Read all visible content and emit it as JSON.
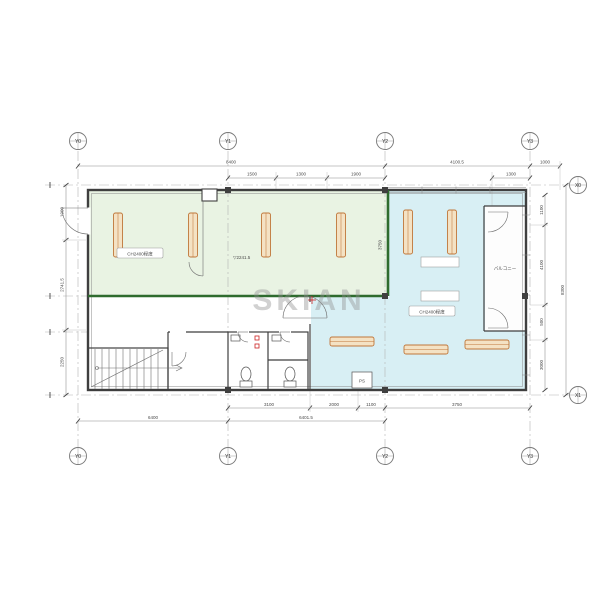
{
  "watermark": "SKIAN",
  "grid": {
    "cols": [
      "Y0",
      "Y1",
      "Y2",
      "Y3"
    ],
    "rows": [
      "X0",
      "X1"
    ]
  },
  "dims": {
    "top1": [
      "8400",
      "4100.5",
      "1000"
    ],
    "top2": [
      "1500",
      "1300",
      "1900",
      "1300"
    ],
    "bottom1": [
      "3100",
      "2000",
      "1100",
      "3750"
    ],
    "bottom2": [
      "6400",
      "6401.5"
    ],
    "left": [
      "1900",
      "2741.5",
      "2250"
    ],
    "right": [
      "1100",
      "4100",
      "500",
      "3000"
    ],
    "rightTotal": "8300",
    "interior": "3750"
  },
  "labels": {
    "leftRoomCeiling": "CH2400程度",
    "rightRoomCeiling": "CH2400程度",
    "levelNote": "▽2241.5",
    "balcony": "バルコニー",
    "ps": "PS"
  },
  "colors": {
    "leftRoomFill": "#e9f3e3",
    "rightRoomFill": "#d8eff4",
    "roomBorder": "#2e6b2e",
    "deskFill": "#f4e2c4",
    "deskStroke": "#c0773a",
    "wall": "#3f3f3f",
    "accentRed": "#cc2222"
  }
}
